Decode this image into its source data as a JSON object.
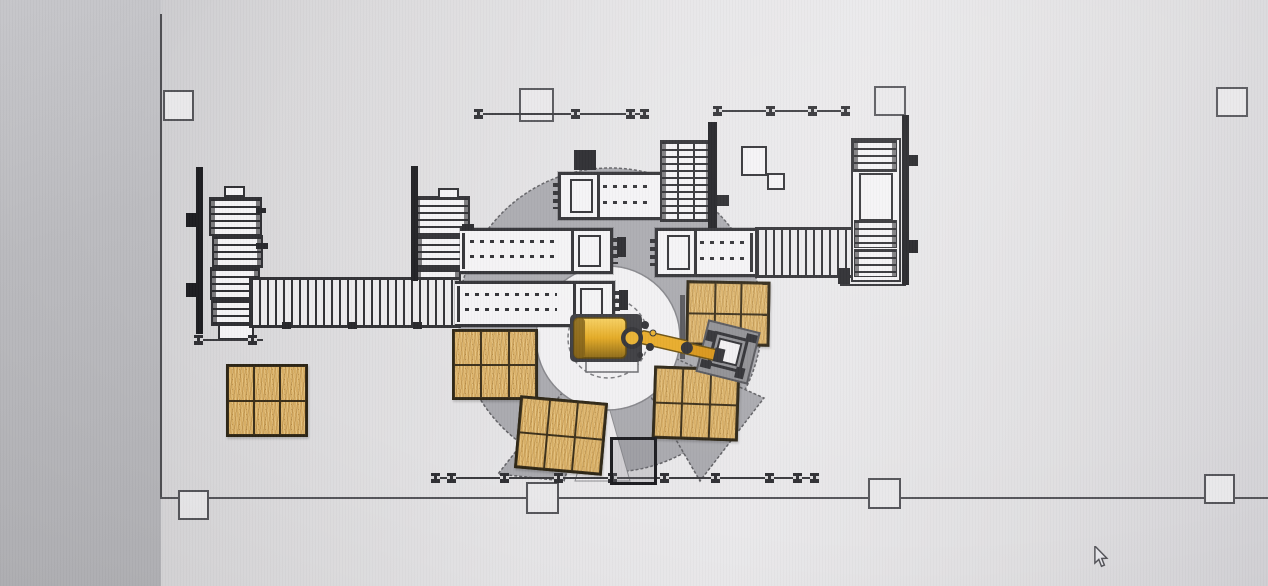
{
  "scene": {
    "type": "cad-floorplan-photo",
    "subject": "robotic-palletizing-cell-layout"
  },
  "colors": {
    "machine_white": "#f4f3f5",
    "line": "#2f2f33",
    "paper": "#e9e8ea",
    "envelope_gray": "#a9a9ae",
    "envelope_edge": "#606064",
    "circle_white": "#f1f0f2",
    "wood": "#d8ae64",
    "wood_dark": "#b98e46",
    "robot_yellow": "#eab02e",
    "robot_yellow_dark": "#8a6612",
    "gripper_gray": "#8f8f93"
  },
  "cursor": {
    "x": 1092,
    "y": 546
  },
  "building": {
    "walls": {
      "left": {
        "x": 160,
        "y1": 14,
        "y2": 497
      },
      "bottom": {
        "y": 497,
        "x1": 160,
        "x2": 1268
      }
    },
    "columns": [
      {
        "x": 163,
        "y": 90,
        "w": 27,
        "h": 27
      },
      {
        "x": 519,
        "y": 88,
        "w": 31,
        "h": 30
      },
      {
        "x": 874,
        "y": 86,
        "w": 28,
        "h": 26
      },
      {
        "x": 1216,
        "y": 87,
        "w": 28,
        "h": 26
      },
      {
        "x": 178,
        "y": 490,
        "w": 27,
        "h": 26
      },
      {
        "x": 526,
        "y": 482,
        "w": 29,
        "h": 28
      },
      {
        "x": 868,
        "y": 478,
        "w": 29,
        "h": 27
      },
      {
        "x": 1204,
        "y": 474,
        "w": 27,
        "h": 26
      }
    ]
  },
  "fences": {
    "segments": [
      {
        "x1": 476,
        "x2": 645,
        "y": 113,
        "posts": [
          474,
          571,
          626,
          640
        ]
      },
      {
        "x1": 714,
        "x2": 846,
        "y": 110,
        "posts": [
          713,
          766,
          808,
          841
        ]
      },
      {
        "x1": 196,
        "x2": 263,
        "y": 339,
        "posts": [
          194,
          248
        ]
      },
      {
        "x1": 431,
        "x2": 816,
        "y": 477,
        "posts": [
          431,
          447,
          500,
          554,
          608,
          660,
          711,
          765,
          793,
          810
        ]
      }
    ],
    "gate": {
      "x": 610,
      "y": 437,
      "w": 41,
      "h": 42
    }
  },
  "guards": [
    {
      "x": 196,
      "y": 167,
      "w": 7,
      "h": 167
    },
    {
      "x": 411,
      "y": 166,
      "w": 7,
      "h": 115
    },
    {
      "x": 708,
      "y": 122,
      "w": 9,
      "h": 106
    },
    {
      "x": 902,
      "y": 115,
      "w": 7,
      "h": 170
    },
    {
      "x": 186,
      "y": 213,
      "w": 13,
      "h": 14
    },
    {
      "x": 186,
      "y": 283,
      "w": 13,
      "h": 14
    },
    {
      "x": 905,
      "y": 155,
      "w": 13,
      "h": 11
    },
    {
      "x": 905,
      "y": 240,
      "w": 13,
      "h": 13
    }
  ],
  "pallets": [
    {
      "x": 226,
      "y": 364,
      "w": 76,
      "h": 67,
      "cols": 3,
      "rows": 2,
      "rot": 0
    },
    {
      "x": 452,
      "y": 329,
      "w": 80,
      "h": 65,
      "cols": 3,
      "rows": 2,
      "rot": 0
    },
    {
      "x": 517,
      "y": 399,
      "w": 82,
      "h": 67,
      "cols": 3,
      "rows": 2,
      "rot": 5
    },
    {
      "x": 686,
      "y": 281,
      "w": 78,
      "h": 59,
      "cols": 3,
      "rows": 2,
      "rot": 1
    },
    {
      "x": 653,
      "y": 367,
      "w": 80,
      "h": 67,
      "cols": 3,
      "rows": 2,
      "rot": 2
    }
  ],
  "labels": [
    {
      "x": 224,
      "y": 186
    },
    {
      "x": 438,
      "y": 188
    }
  ],
  "machines": {
    "names": [
      "pallet-magazine-left",
      "pallet-magazine-mid",
      "infeed-slat-conveyor",
      "press-station-left-upper",
      "press-station-left-lower",
      "press-station-top",
      "roller-unit-top-right",
      "press-station-right",
      "slat-conveyor-right",
      "stacker-unit-right",
      "robot-work-envelope",
      "palletizing-robot",
      "robot-gripper"
    ]
  }
}
